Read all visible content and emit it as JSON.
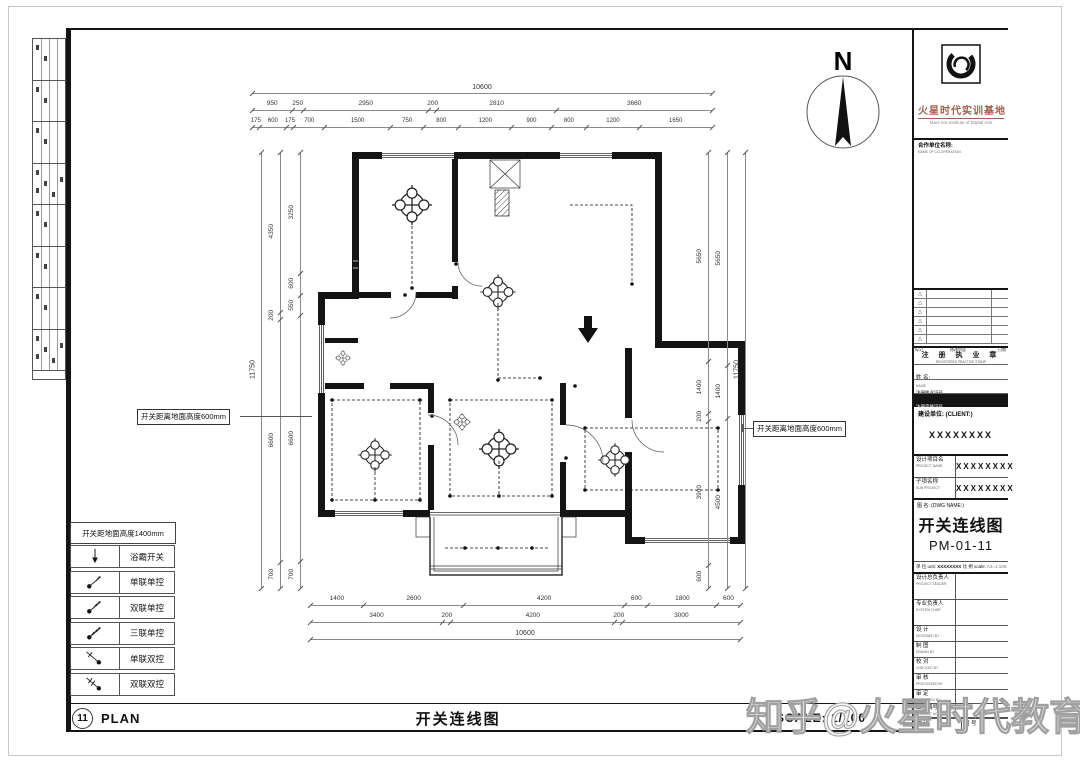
{
  "watermark": "知乎@火星时代教育",
  "north_label": "N",
  "bottom_bar": {
    "number": "11",
    "label": "PLAN",
    "title": "开关连线图",
    "scale": "SCALE: 1/100"
  },
  "annotations": {
    "left": "开关距离地面高度600mm",
    "right": "开关距离地面高度600mm"
  },
  "legend": {
    "header": "开关距地面高度1400mm",
    "items": [
      {
        "icon": "bath-heater-arrow",
        "label": "浴霸开关"
      },
      {
        "icon": "single-gang-single",
        "label": "单联单控"
      },
      {
        "icon": "double-gang-single",
        "label": "双联单控"
      },
      {
        "icon": "triple-gang-single",
        "label": "三联单控"
      },
      {
        "icon": "single-gang-double",
        "label": "单联双控"
      },
      {
        "icon": "double-gang-double",
        "label": "双联双控"
      }
    ]
  },
  "dimensions": {
    "top": [
      [
        "10600"
      ],
      [
        "950",
        "250",
        "2950",
        "200",
        "2810",
        "3660"
      ],
      [
        "175",
        "600",
        "175",
        "700",
        "1500",
        "750",
        "800",
        "1200",
        "900",
        "800",
        "1200",
        "1650"
      ]
    ],
    "bottom": [
      [
        "1400",
        "2600",
        "4200",
        "600",
        "1800",
        "600"
      ],
      [
        "3400",
        "200",
        "4200",
        "200",
        "3000"
      ],
      [
        "10600"
      ]
    ],
    "left": [
      [
        "3250",
        "600",
        "550",
        "6600",
        "700"
      ],
      [
        "4350",
        "200",
        "6600",
        "700"
      ],
      [
        "11750"
      ]
    ],
    "right": [
      [
        "5650",
        "1400",
        "200",
        "3900",
        "600"
      ],
      [
        "5650",
        "1400",
        "4500"
      ],
      [
        "11750"
      ]
    ]
  },
  "title_block": {
    "brand": {
      "name": "火星时代实训基地",
      "english": "Mars era Institute of Digital Arts"
    },
    "cooperation": {
      "cn": "合作单位名称:",
      "en": "NAME OF CO-OPERATION."
    },
    "revision": {
      "mark": "△",
      "c1": "标记",
      "c2": "修改内容",
      "c3": "日期"
    },
    "stamp": {
      "title_cn": "注 册 执 业 章",
      "title_en": "REGISTERED PRACTICE STAMP",
      "name_cn": "姓 名:",
      "name_en": "NAME",
      "license_cn": "注册执业证号",
      "license_en": "REGISTERED LICENCE NO.",
      "cert_cn": "注册资格证号",
      "cert_en": "REGISTERED CERTIFICATE NO."
    },
    "client": {
      "label": "建设单位: (CLIENT:)",
      "value": "XXXXXXXX"
    },
    "project": {
      "cn": "设计项目名",
      "en": "PROJECT NAME",
      "value": "XXXXXXXX"
    },
    "subproject": {
      "cn": "子项名称",
      "en": "SUB PROJECT",
      "value": "XXXXXXXX"
    },
    "dwg": {
      "label": "图 名: (DWG NAME:)",
      "name": "开关连线图",
      "number": "PM-01-11"
    },
    "meta": {
      "unit_label": "单 位 unit:",
      "unit_value": "XXXXXXXX",
      "scale_label": "比 例 scale:",
      "scale_value": "A3=1:100"
    },
    "signoff": [
      {
        "cn": "设计总负责人",
        "en": "PROJECT LEADER"
      },
      {
        "cn": "专业负责人",
        "en": "SYSTEM CHIEF"
      },
      {
        "cn": "设 计",
        "en": "DESIGNED BY"
      },
      {
        "cn": "制 图",
        "en": "DRAWN BY"
      },
      {
        "cn": "校 对",
        "en": "CHECKED BY"
      },
      {
        "cn": "审 核",
        "en": "PROCESSED BY"
      },
      {
        "cn": "审 定",
        "en": "APPROVED BY"
      },
      {
        "cn": "工程编号",
        "en": "PROJECT NO."
      }
    ],
    "bottom_cells": {
      "a": "图 别",
      "b": "图 号"
    }
  }
}
